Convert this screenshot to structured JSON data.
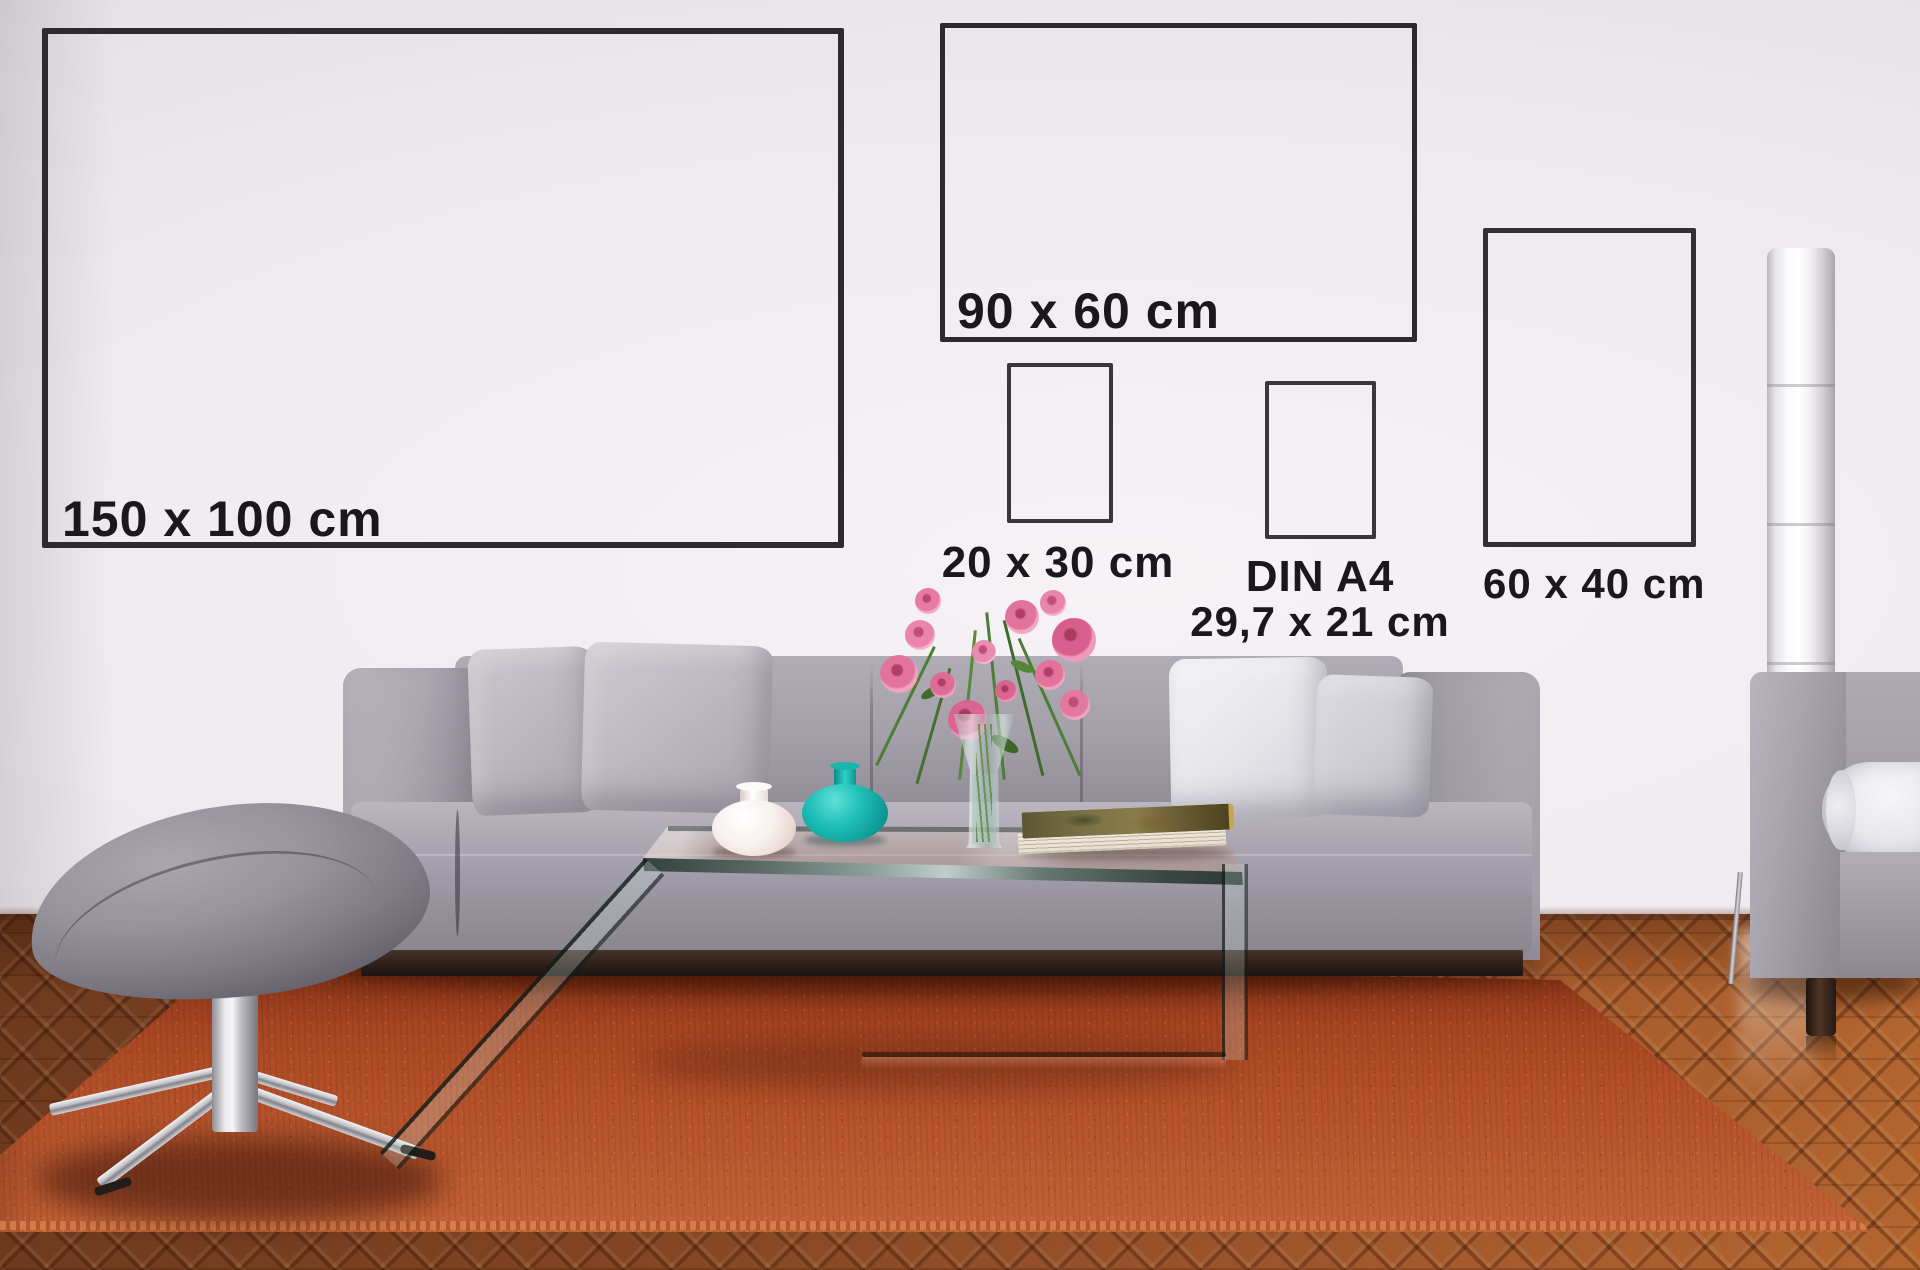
{
  "size_guide": {
    "title_hint": "poster size comparison on living-room wall",
    "frames": [
      {
        "id": "150x100",
        "label": "150 x 100 cm"
      },
      {
        "id": "90x60",
        "label": "90 x 60 cm"
      },
      {
        "id": "20x30",
        "label": "20 x 30 cm"
      },
      {
        "id": "din-a4",
        "label": "DIN A4",
        "sublabel": "29,7 x 21 cm"
      },
      {
        "id": "60x40",
        "label": "60 x 40 cm"
      }
    ]
  },
  "colors": {
    "wall": "#eeeaef",
    "frame_stroke": "#2e2b30",
    "label_text": "#1a181c",
    "sofa_fabric": "#a29ea8",
    "pillow_light": "#c3bec6",
    "pillow_white": "#efeef3",
    "rug_orange": "#b4512a",
    "wood_floor": "#8a4a24",
    "teal_vase": "#14b3ac",
    "white_vase": "#f7f2f1",
    "flower_pink": "#e87ca1",
    "stem_green": "#4a7c33",
    "book_cover": "#7a7146",
    "lamp_white": "#fbfafc"
  }
}
